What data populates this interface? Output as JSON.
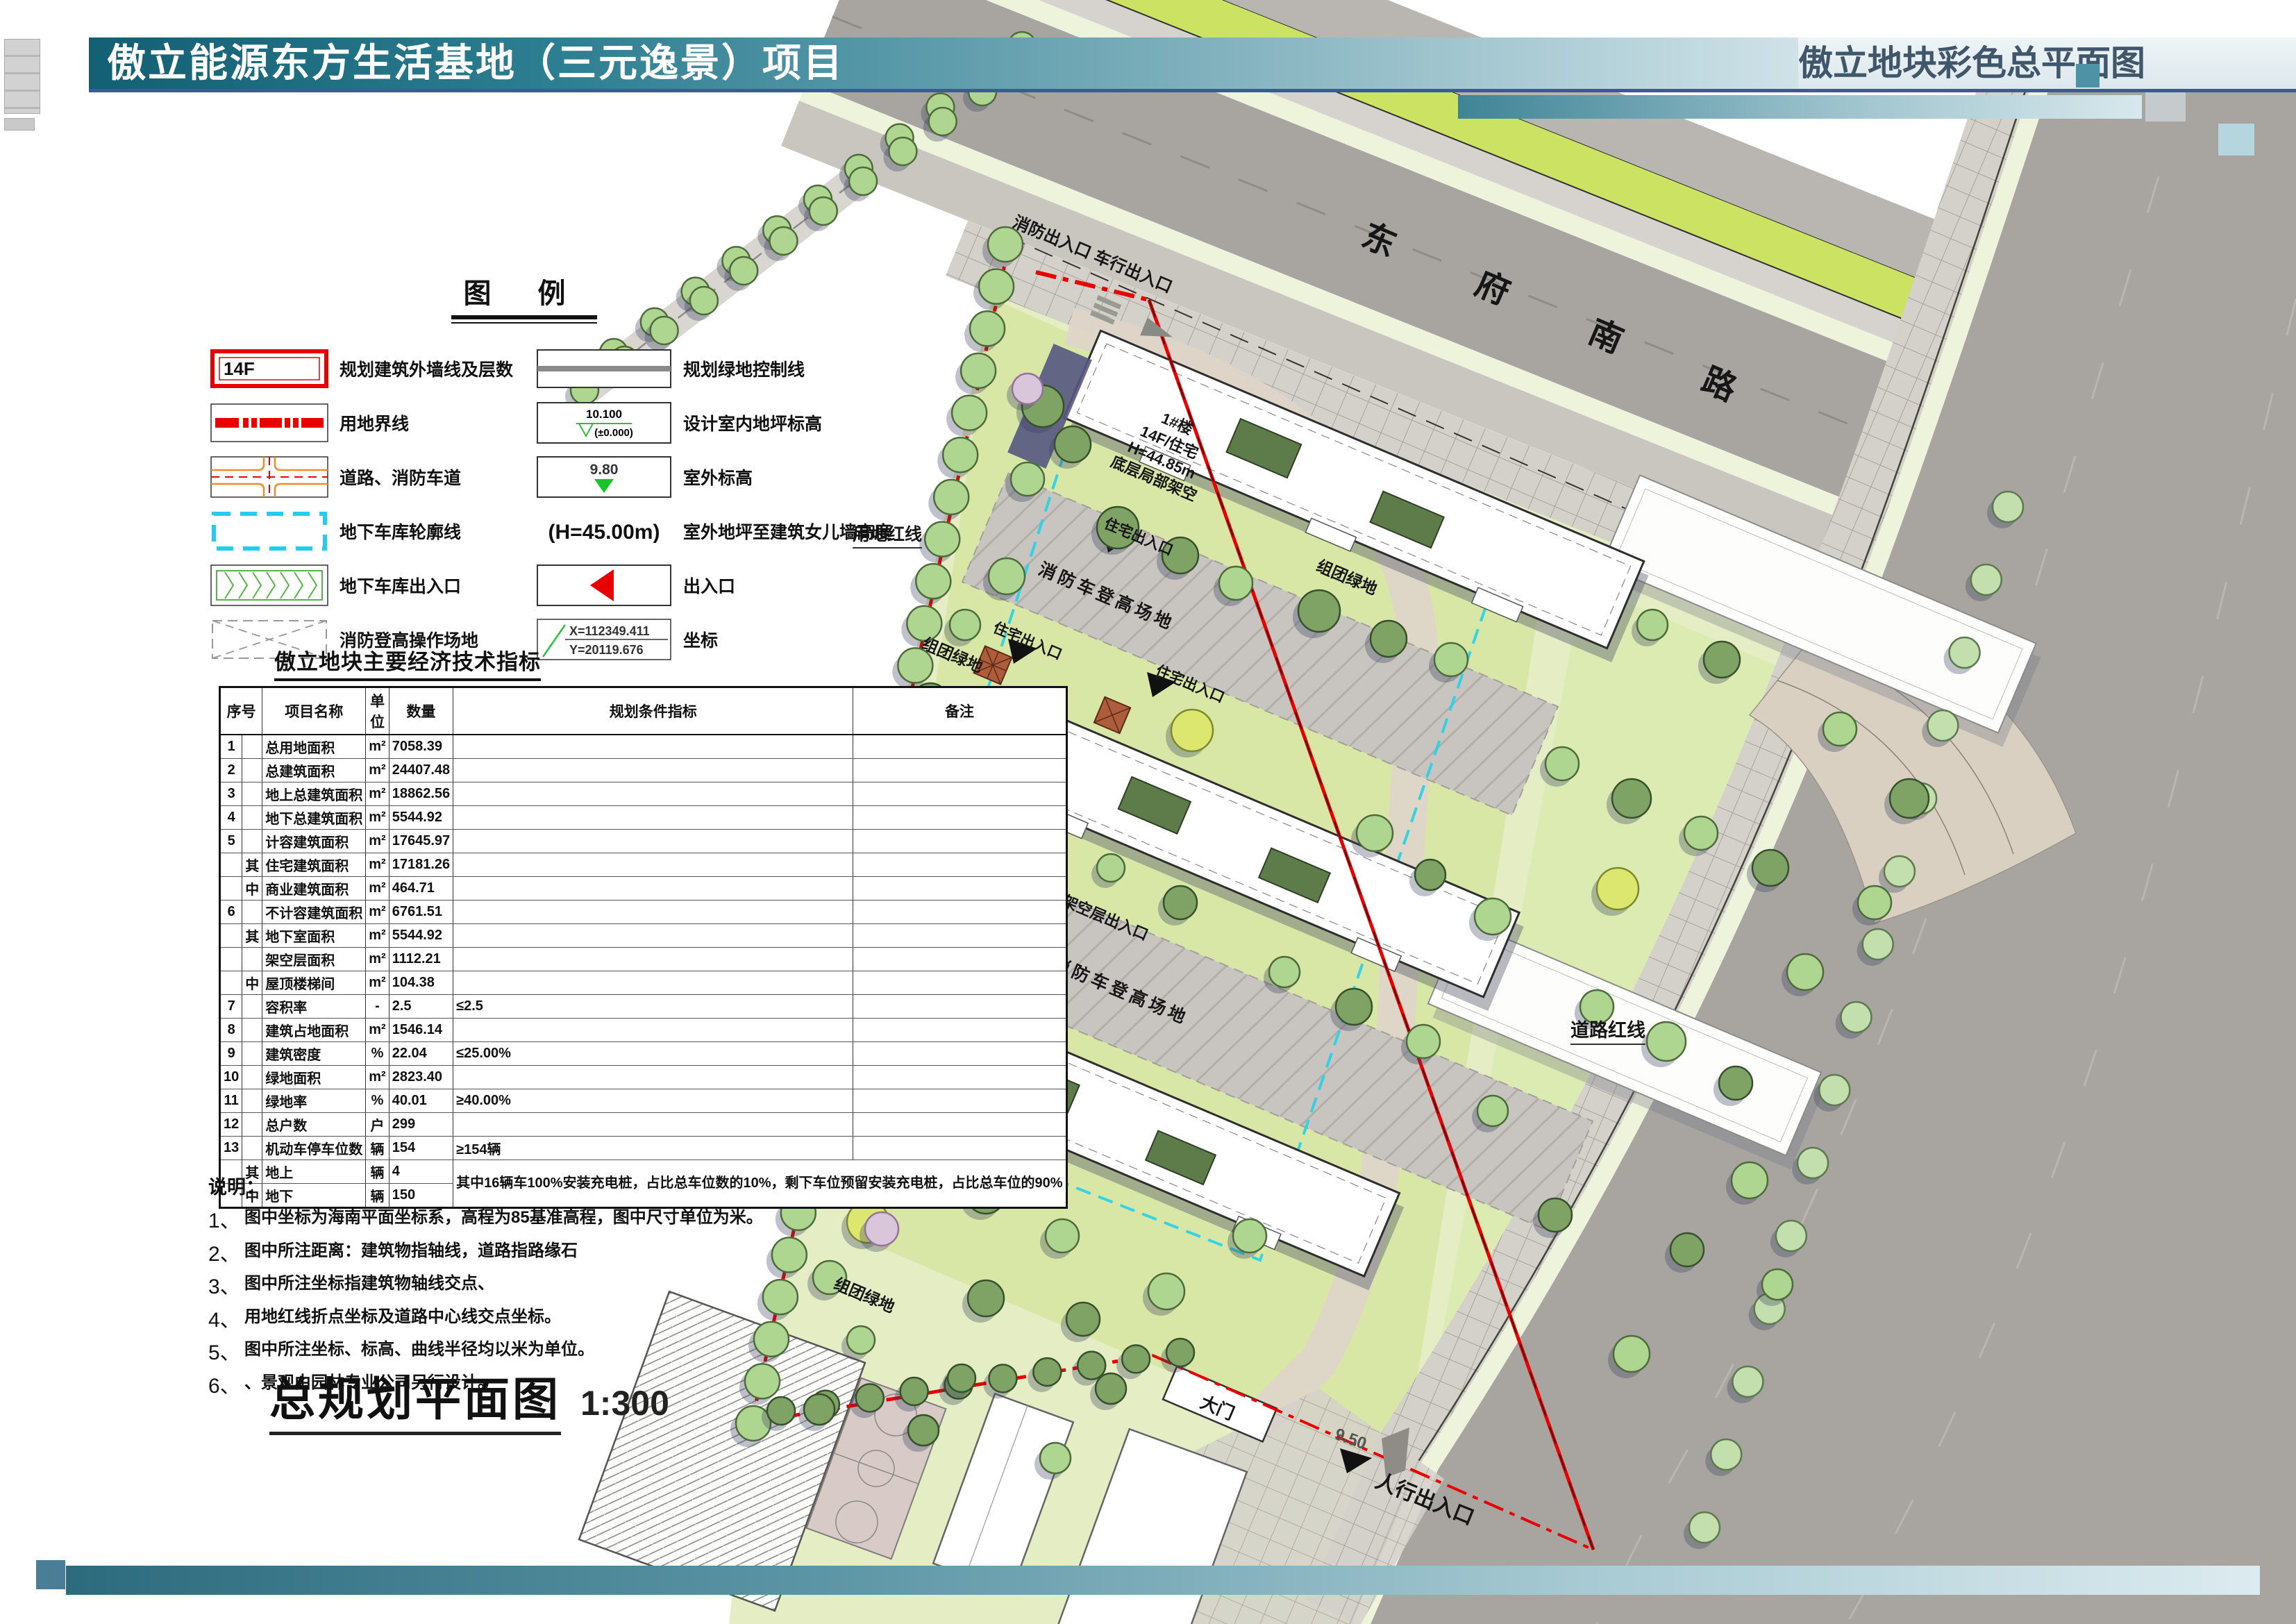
{
  "header": {
    "left_title": "傲立能源东方生活基地（三元逸景）项目",
    "right_title": "傲立地块彩色总平面图"
  },
  "legend": {
    "title": "图  例",
    "items_left": [
      {
        "symbol": "building-outline",
        "symbol_text": "14F",
        "label": "规划建筑外墙线及层数"
      },
      {
        "symbol": "land-boundary",
        "label": "用地界线"
      },
      {
        "symbol": "road-fire-lane",
        "label": "道路、消防车道"
      },
      {
        "symbol": "garage-outline",
        "label": "地下车库轮廓线"
      },
      {
        "symbol": "garage-entrance",
        "label": "地下车库出入口"
      },
      {
        "symbol": "fire-operation-area",
        "label": "消防登高操作场地"
      }
    ],
    "items_right": [
      {
        "symbol": "green-control-line",
        "label": "规划绿地控制线"
      },
      {
        "symbol": "indoor-elevation",
        "value": "10.100",
        "value2": "(±0.000)",
        "label": "设计室内地坪标高"
      },
      {
        "symbol": "outdoor-elevation",
        "value": "9.80",
        "label": "室外标高"
      },
      {
        "symbol": "parapet-height",
        "value": "(H=45.00m)",
        "label": "室外地坪至建筑女儿墙高度"
      },
      {
        "symbol": "entrance-arrow",
        "label": "出入口"
      },
      {
        "symbol": "coordinate",
        "value_x": "X=112349.411",
        "value_y": "Y=20119.676",
        "label": "坐标"
      }
    ]
  },
  "table": {
    "title": "傲立地块主要经济技术指标",
    "headers": [
      "序号",
      "项目名称",
      "单位",
      "数量",
      "规划条件指标",
      "备注"
    ],
    "rows": [
      {
        "no": "1",
        "sub": "",
        "name": "总用地面积",
        "unit": "m²",
        "qty": "7058.39",
        "plan": "",
        "note": ""
      },
      {
        "no": "2",
        "sub": "",
        "name": "总建筑面积",
        "unit": "m²",
        "qty": "24407.48",
        "plan": "",
        "note": ""
      },
      {
        "no": "3",
        "sub": "",
        "name": "地上总建筑面积",
        "unit": "m²",
        "qty": "18862.56",
        "plan": "",
        "note": ""
      },
      {
        "no": "4",
        "sub": "",
        "name": "地下总建筑面积",
        "unit": "m²",
        "qty": "5544.92",
        "plan": "",
        "note": ""
      },
      {
        "no": "5",
        "sub": "",
        "name": "计容建筑面积",
        "unit": "m²",
        "qty": "17645.97",
        "plan": "",
        "note": ""
      },
      {
        "no": "",
        "sub": "其",
        "name": "住宅建筑面积",
        "unit": "m²",
        "qty": "17181.26",
        "plan": "",
        "note": ""
      },
      {
        "no": "",
        "sub": "中",
        "name": "商业建筑面积",
        "unit": "m²",
        "qty": "464.71",
        "plan": "",
        "note": ""
      },
      {
        "no": "6",
        "sub": "",
        "name": "不计容建筑面积",
        "unit": "m²",
        "qty": "6761.51",
        "plan": "",
        "note": ""
      },
      {
        "no": "",
        "sub": "其",
        "name": "地下室面积",
        "unit": "m²",
        "qty": "5544.92",
        "plan": "",
        "note": ""
      },
      {
        "no": "",
        "sub": "",
        "name": "架空层面积",
        "unit": "m²",
        "qty": "1112.21",
        "plan": "",
        "note": ""
      },
      {
        "no": "",
        "sub": "中",
        "name": "屋顶楼梯间",
        "unit": "m²",
        "qty": "104.38",
        "plan": "",
        "note": ""
      },
      {
        "no": "7",
        "sub": "",
        "name": "容积率",
        "unit": "-",
        "qty": "2.5",
        "plan": "≤2.5",
        "note": ""
      },
      {
        "no": "8",
        "sub": "",
        "name": "建筑占地面积",
        "unit": "m²",
        "qty": "1546.14",
        "plan": "",
        "note": ""
      },
      {
        "no": "9",
        "sub": "",
        "name": "建筑密度",
        "unit": "%",
        "qty": "22.04",
        "plan": "≤25.00%",
        "note": ""
      },
      {
        "no": "10",
        "sub": "",
        "name": "绿地面积",
        "unit": "m²",
        "qty": "2823.40",
        "plan": "",
        "note": ""
      },
      {
        "no": "11",
        "sub": "",
        "name": "绿地率",
        "unit": "%",
        "qty": "40.01",
        "plan": "≥40.00%",
        "note": ""
      },
      {
        "no": "12",
        "sub": "",
        "name": "总户数",
        "unit": "户",
        "qty": "299",
        "plan": "",
        "note": ""
      },
      {
        "no": "13",
        "sub": "",
        "name": "机动车停车位数",
        "unit": "辆",
        "qty": "154",
        "plan": "≥154辆",
        "note": ""
      },
      {
        "no": "",
        "sub": "其",
        "name": "地上",
        "unit": "辆",
        "qty": "4",
        "plan": "其中16辆车100%安装充电桩，占比总车位数的10%，剩下车位预留安装充电桩，占比总车位的90%",
        "note": ""
      },
      {
        "no": "",
        "sub": "中",
        "name": "地下",
        "unit": "辆",
        "qty": "150",
        "plan": "",
        "note": ""
      }
    ]
  },
  "notes": {
    "title": "说明：",
    "items": [
      {
        "num": "1、",
        "text": "图中坐标为海南平面坐标系，高程为85基准高程，图中尺寸单位为米。"
      },
      {
        "num": "2、",
        "text": "图中所注距离：建筑物指轴线，道路指路缘石"
      },
      {
        "num": "3、",
        "text": "图中所注坐标指建筑物轴线交点、"
      },
      {
        "num": "4、",
        "text": "用地红线折点坐标及道路中心线交点坐标。"
      },
      {
        "num": "5、",
        "text": "图中所注坐标、标高、曲线半径均以米为单位。"
      },
      {
        "num": "6、",
        "text": "、景观由园林专业公司另行设计。"
      }
    ]
  },
  "plan_title": {
    "text": "总规划平面图",
    "scale": "1:300"
  },
  "map": {
    "road_name": "东 府 南 路",
    "labels": {
      "entrance_top": "消防出入口 车行出入口",
      "fire_climb_area": "消防车登高场地",
      "residential_entrance": "住宅出入口",
      "group_green": "组团绿地",
      "barrier_free_ramp": "无障碍坡道",
      "stilt_floor_entrance": "架空层出入口",
      "land_red_line": "用地红线",
      "road_red_line": "道路红线",
      "pedestrian_entrance": "人行出入口",
      "gate": "大门",
      "outdoor_level": "9.50"
    },
    "buildings": [
      {
        "name": "1#楼",
        "type": "14F/住宅",
        "height": "H=44.85m",
        "note": "底层局部架空"
      },
      {
        "name": "2#楼",
        "type": "14F/住宅",
        "height": "H=44.85m",
        "note": "底层架空"
      },
      {
        "name": "3#楼",
        "type": "14F/住宅",
        "height": "H=44.85m",
        "note": "底层架空"
      }
    ]
  },
  "colors": {
    "title_bar_teal": "#135f73",
    "accent_blue": "#3a5a9a",
    "boundary_red": "#e80000",
    "road_gray": "#a8a5a1",
    "verge_green": "#cbe263",
    "site_green": "#e4edc3",
    "tree_green": "#aed690",
    "garage_cyan": "#25d0ea"
  }
}
